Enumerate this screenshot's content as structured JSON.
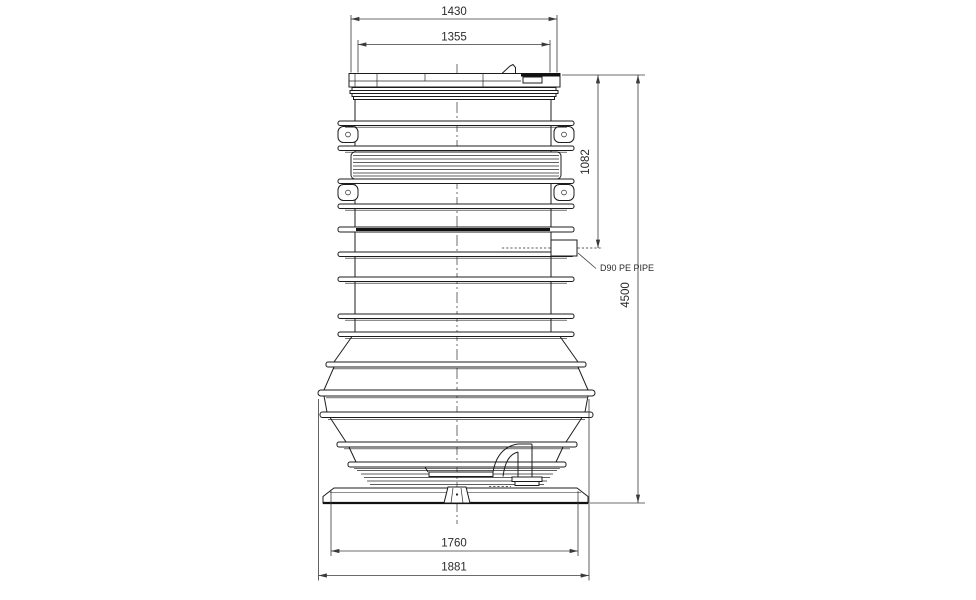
{
  "page": {
    "background": "#ffffff"
  },
  "colors": {
    "line": "#1c1c1c",
    "dimension": "#3a3a3a",
    "background": "#ffffff"
  },
  "dimensions": {
    "lid_outer_width": {
      "value": "1430"
    },
    "lid_inner_width": {
      "value": "1355"
    },
    "inlet_depth_from_top": {
      "value": "1082"
    },
    "overall_height": {
      "value": "4500"
    },
    "base_plate_width": {
      "value": "1760"
    },
    "max_body_width": {
      "value": "1881"
    }
  },
  "labels": {
    "inlet_pipe": "D90 PE PIPE"
  }
}
